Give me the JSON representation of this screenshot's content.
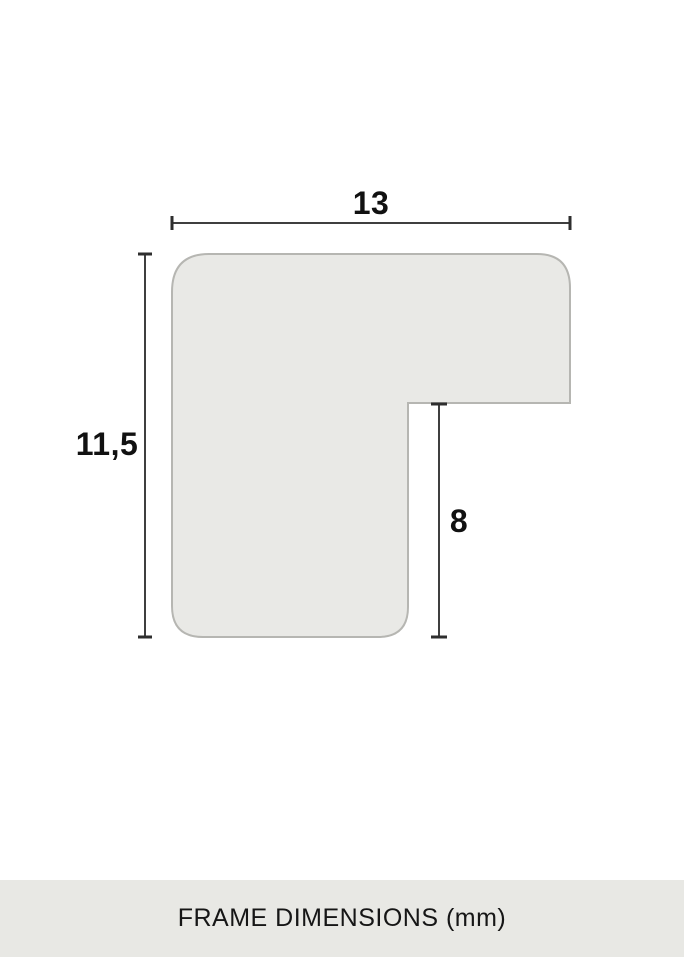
{
  "diagram": {
    "type": "frame-profile-cross-section",
    "dimensions": {
      "width_label": "13",
      "height_label": "11,5",
      "rabbet_label": "8"
    },
    "colors": {
      "background": "#ffffff",
      "shape_fill": "#e9e9e6",
      "shape_border": "#b6b6b2",
      "dimension_line": "#3f3f3f",
      "label_text": "#111111"
    }
  },
  "footer": {
    "caption": "FRAME DIMENSIONS (mm)",
    "background": "#e8e8e4",
    "text_color": "#161616"
  }
}
